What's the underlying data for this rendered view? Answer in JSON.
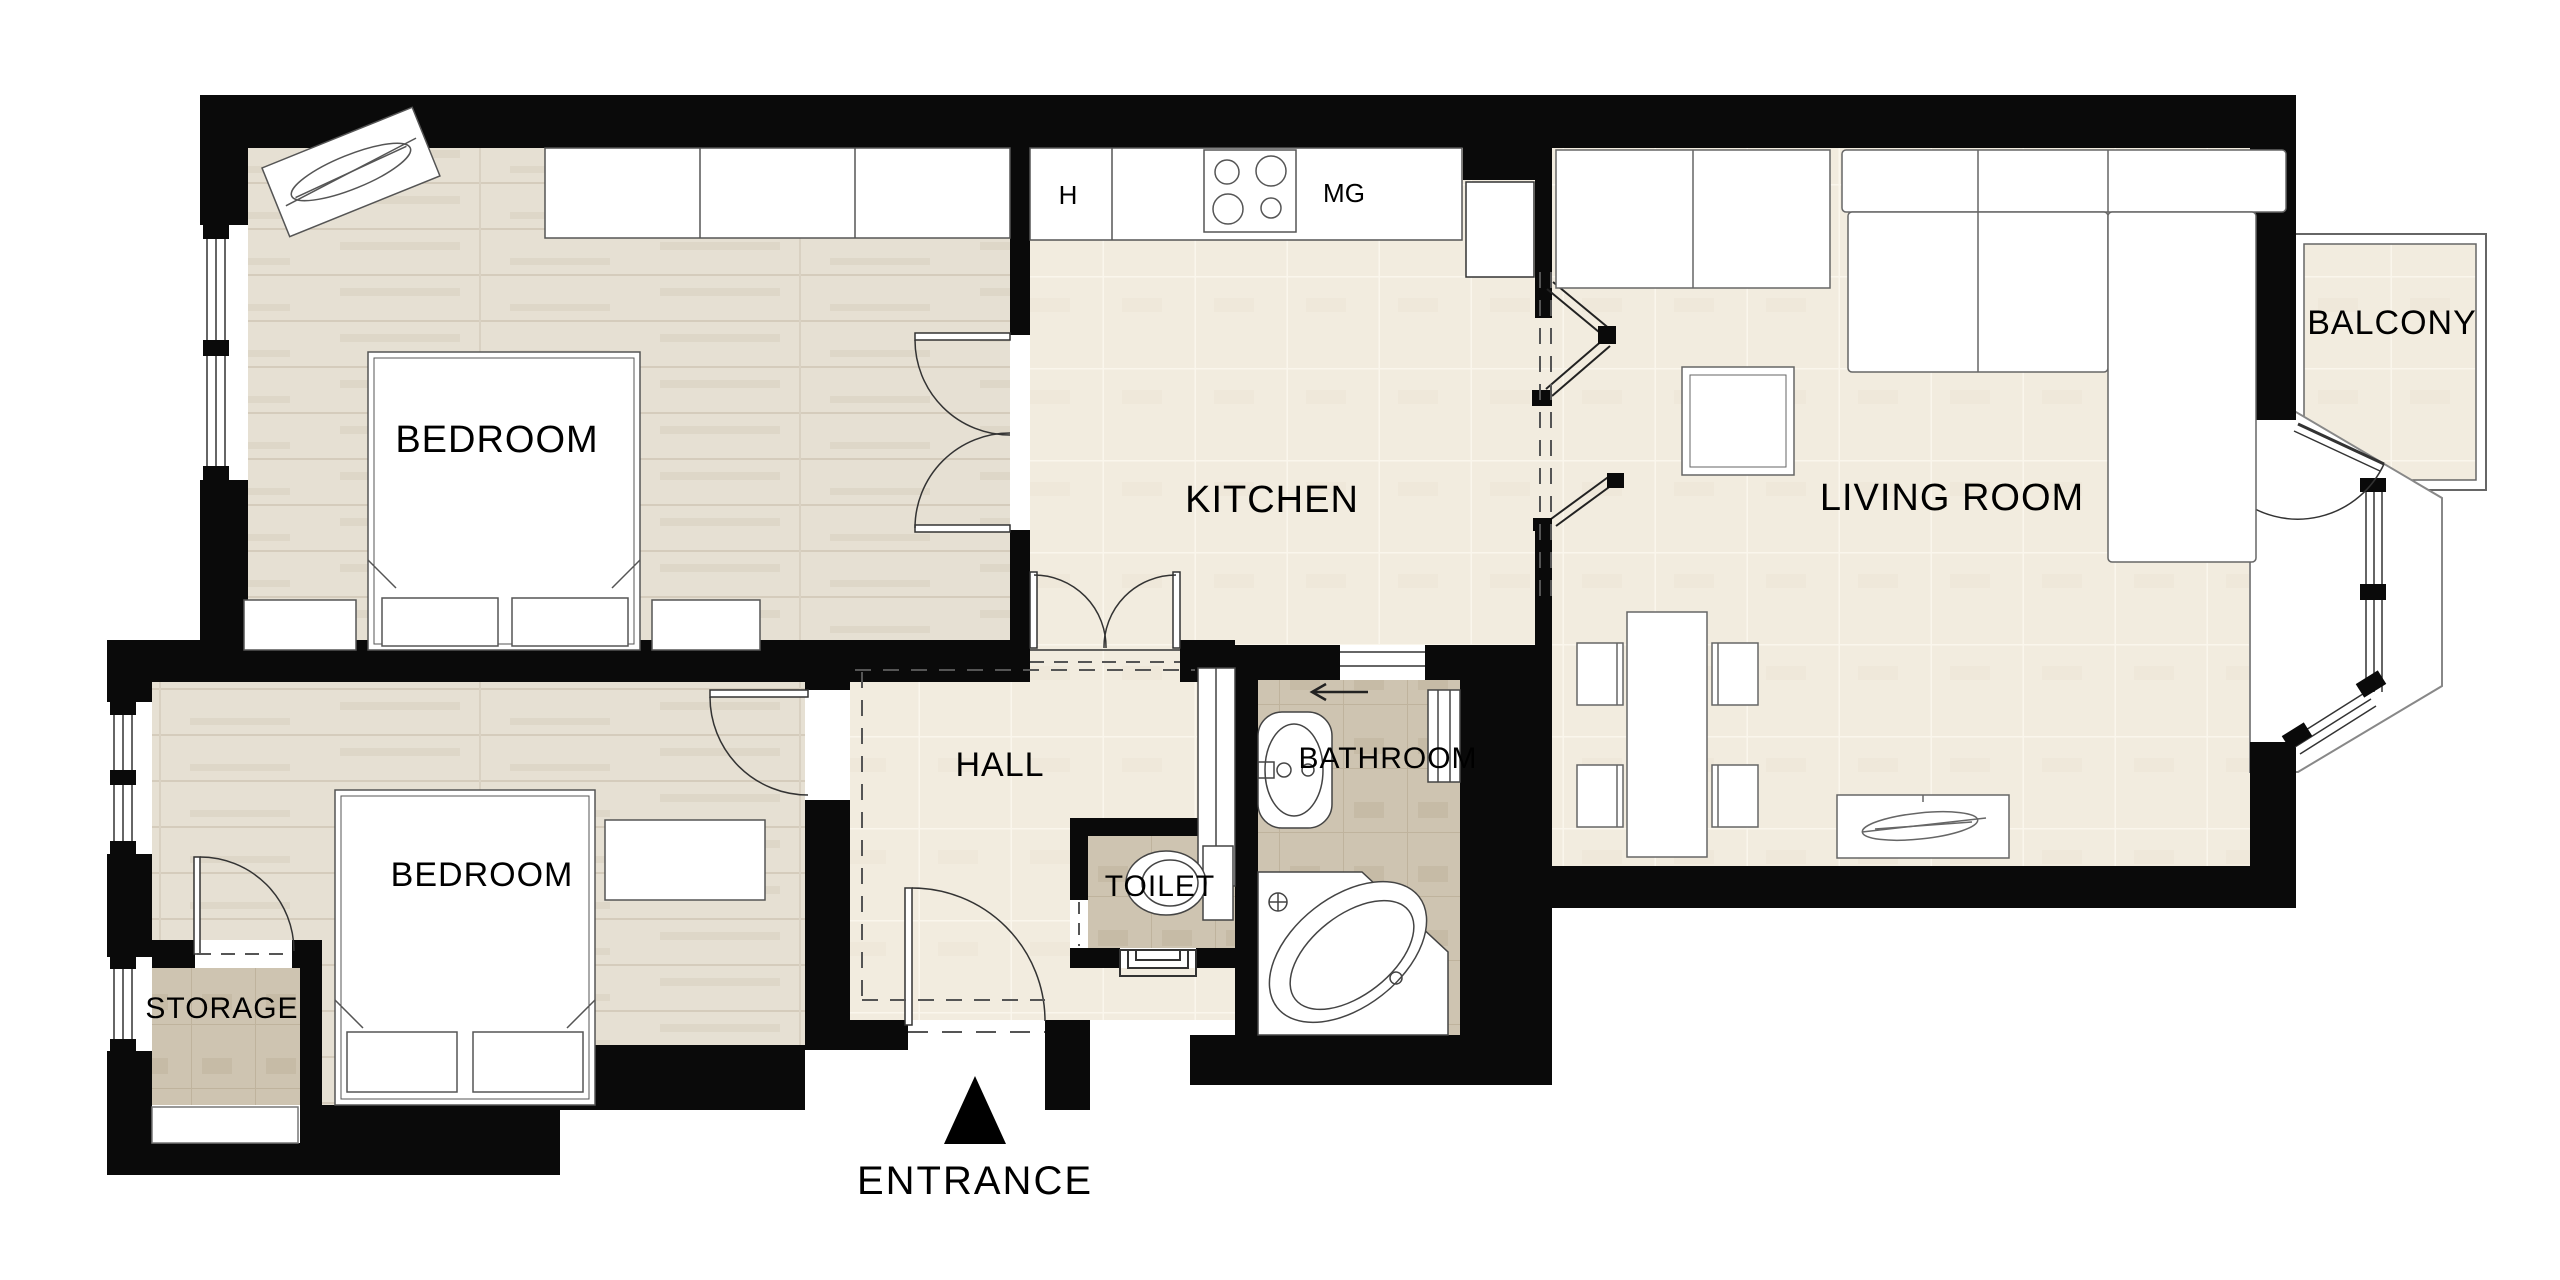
{
  "rooms": {
    "bedroom_top": {
      "label": "BEDROOM"
    },
    "kitchen": {
      "label": "KITCHEN"
    },
    "living_room": {
      "label": "LIVING ROOM"
    },
    "balcony": {
      "label": "BALCONY"
    },
    "bedroom_bottom": {
      "label": "BEDROOM"
    },
    "storage": {
      "label": "STORAGE"
    },
    "hall": {
      "label": "HALL"
    },
    "toilet": {
      "label": "TOILET"
    },
    "bathroom": {
      "label": "BATHROOM"
    }
  },
  "kitchen_appliances": {
    "hob_label": "H",
    "microwave_label": "MG"
  },
  "entrance": {
    "label": "ENTRANCE"
  },
  "colors": {
    "wall": "#0a0a0a",
    "floor_cream": "#f2ecdf",
    "floor_wood": "#e6e0d3",
    "floor_tan": "#cec4b1",
    "outline": "#555555"
  }
}
